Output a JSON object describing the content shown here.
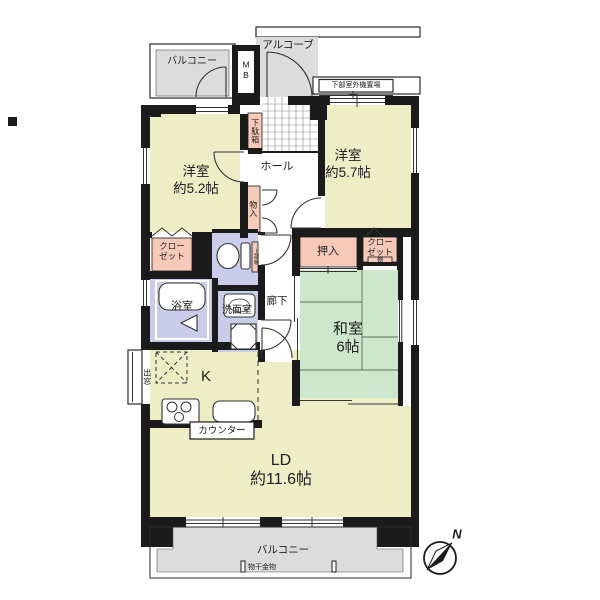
{
  "plan": {
    "labels": {
      "alcove": "アルコーブ",
      "balcony_top": "バルコニー",
      "mb": "MB",
      "outdoor_unit": "下部室外機置場",
      "shoe_box": "下駄箱",
      "hall": "ホール",
      "room_w52_name": "洋室",
      "room_w52_size": "約5.2帖",
      "room_w57_name": "洋室",
      "room_w57_size": "約5.7帖",
      "storage": "物入",
      "closet_left": "クロー\nゼット",
      "upper_shelf": "上部棚",
      "oshiire": "押入",
      "closet_right": "クロー\nゼット",
      "shelf": "棚",
      "washitsu": "和室\n6帖",
      "bath": "浴室",
      "washroom": "洗面室",
      "corridor": "廊下",
      "bay_window": "出窓",
      "kitchen": "K",
      "counter": "カウンター",
      "living": "LD\n約11.6帖",
      "balcony_bottom": "バルコニー",
      "laundry_hw": "物干金物",
      "north": "N"
    },
    "colors": {
      "wall": "#1b1b1b",
      "western_room": "#edeec6",
      "tatami": "#cde7cc",
      "wet_area": "#c9cde9",
      "storage": "#f6c9b9",
      "balcony": "#dcdcdd",
      "line": "#333333"
    },
    "icons": [
      "toilet-icon",
      "bathtub-icon",
      "washbasin-icon",
      "washing-machine-icon",
      "stove-icon",
      "kitchen-sink-icon",
      "refrigerator-space-icon",
      "compass-icon",
      "door-swing-icon",
      "sliding-door-icon",
      "laundry-bracket-icon"
    ]
  }
}
